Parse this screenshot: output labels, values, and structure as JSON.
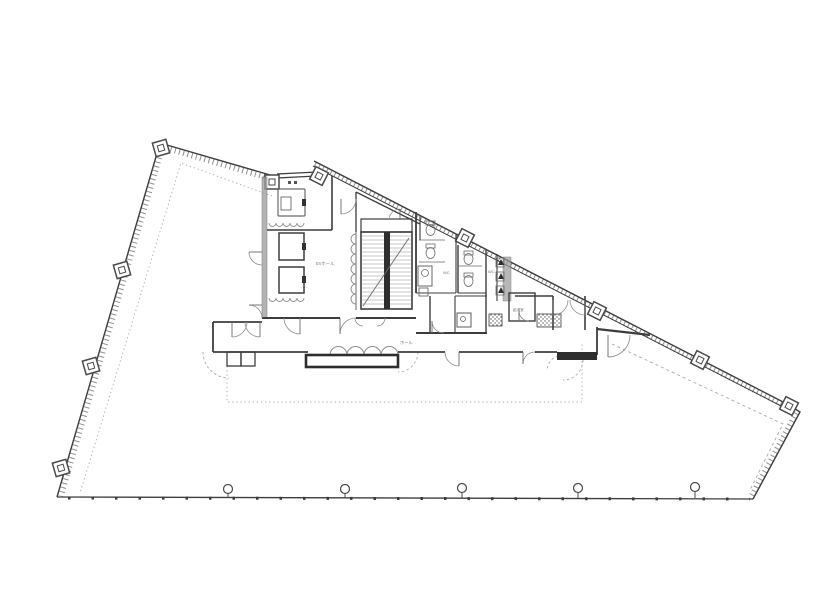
{
  "drawing": {
    "kind": "architectural floor plan (office building typical floor)",
    "colors": {
      "background": "#ffffff",
      "main_line": "#3d3d3d",
      "light_line": "#8f8f8f",
      "dashed_line": "#aaaaaa",
      "dark_fill": "#2e2e2e",
      "wall_hatch_fill": "#9a9a9a"
    },
    "labels": {
      "ev_hall": "EVホール",
      "wc_a": "WC",
      "wc_b": "WC",
      "hall": "ホール",
      "pantry": "給湯室"
    },
    "counts": {
      "elevator_shafts": 3,
      "bottom_row_columns": 5,
      "perimeter_column_markers": 10
    }
  }
}
